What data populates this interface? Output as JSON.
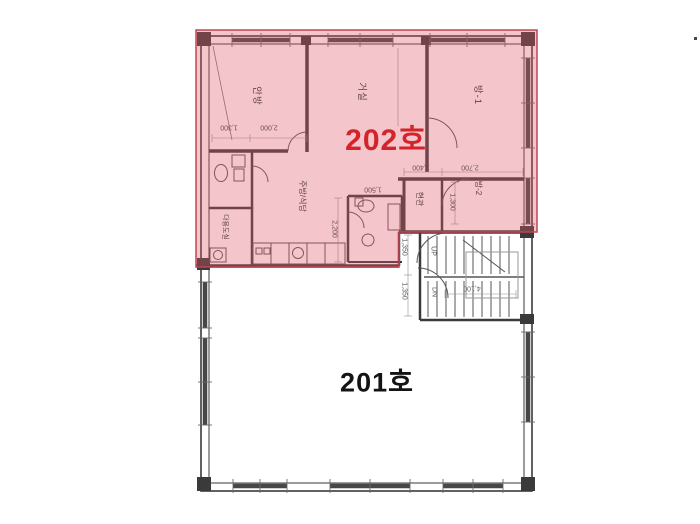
{
  "page": {
    "background": "#ffffff"
  },
  "plan": {
    "unit_202": {
      "label": "202호",
      "label_color": "#d3232b",
      "overlay_fill": "#e05565",
      "overlay_border": "#c04553",
      "rooms": {
        "anbang": "안방",
        "geosil": "거실",
        "bang1": "방-1",
        "bang2": "방-2",
        "hyeongwan": "현관",
        "jubang": "주방/식당",
        "dayongdosil": "다용도실"
      },
      "dimensions": {
        "d1300a": "1,300",
        "d2000": "2,000",
        "d1500": "1,500",
        "d2200": "2,200",
        "d1400": "1,400",
        "d2700": "2,700",
        "d1300b": "1,300"
      }
    },
    "unit_201": {
      "label": "201호",
      "label_color": "#141414"
    },
    "stairs": {
      "up_label": "UP",
      "dn_label": "DN",
      "d4100": "4,100",
      "d1350a": "1,350",
      "d1350b": "1,350"
    },
    "drawing": {
      "wall_color": "#3a3a3a",
      "window_color": "#474747",
      "detail_color": "#555555"
    }
  }
}
